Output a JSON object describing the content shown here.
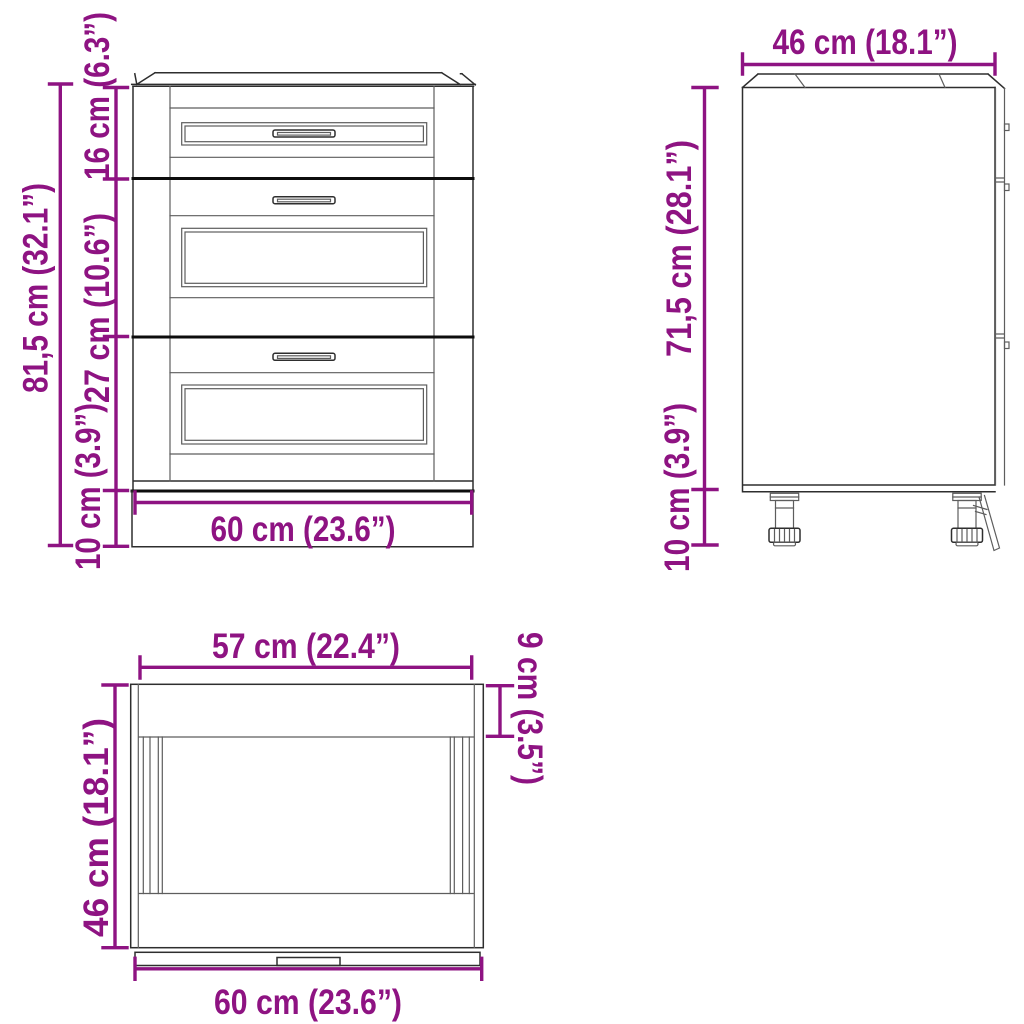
{
  "figure": {
    "type": "product-dimension-diagram",
    "subject": "kitchen base cabinet with three drawers",
    "views_shown": [
      "front",
      "side",
      "top"
    ]
  },
  "colors": {
    "background": "#ffffff",
    "dimension_accent": "#8E1382",
    "outline": "#2e2e2e",
    "detail_line": "#5d5d5d",
    "divider": "#0d0d0d"
  },
  "views": {
    "front": {
      "label": "front view",
      "dims": {
        "total_height": "81,5 cm (32.1”)",
        "top_drawer_height": "16 cm (6.3”)",
        "middle_drawer_height": "27 cm (10.6”)",
        "plinth_height": "10 cm (3.9”)",
        "width": "60 cm (23.6”)"
      }
    },
    "side": {
      "label": "side view",
      "dims": {
        "depth": "46 cm (18.1”)",
        "body_height": "71,5 cm (28.1”)",
        "leg_height": "10 cm (3.9”)"
      }
    },
    "top": {
      "label": "top view",
      "dims": {
        "drawer_front_width": "57 cm (22.4”)",
        "back_rail_depth": "9 cm (3.5”)",
        "depth": "46 cm (18.1”)",
        "width": "60 cm (23.6”)"
      }
    }
  }
}
